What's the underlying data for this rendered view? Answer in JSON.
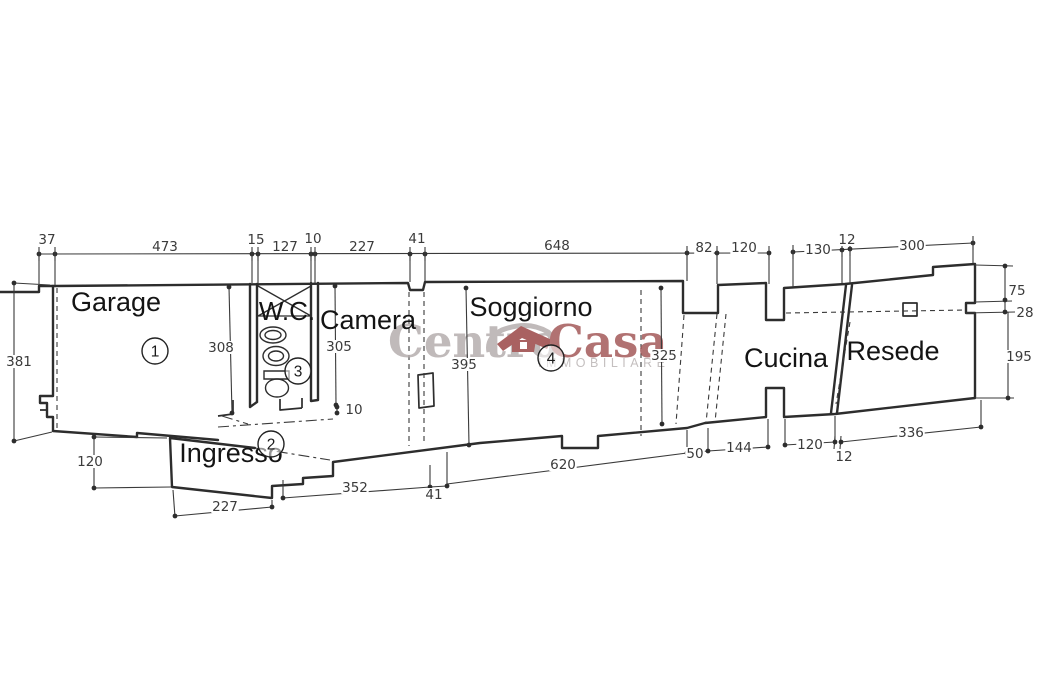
{
  "plan": {
    "type_label": "floor-plan",
    "rooms": [
      {
        "label": "Garage",
        "x": 116,
        "y": 311,
        "fs": 27,
        "num": "1",
        "nx": 155,
        "ny": 351
      },
      {
        "label": "Ingresso",
        "x": 231,
        "y": 462,
        "fs": 27,
        "num": "2",
        "nx": 271,
        "ny": 444
      },
      {
        "label": "W.C.",
        "x": 287,
        "y": 320,
        "fs": 26,
        "num": "3",
        "nx": 298,
        "ny": 371
      },
      {
        "label": "Camera",
        "x": 368,
        "y": 329,
        "fs": 27
      },
      {
        "label": "Soggiorno",
        "x": 531,
        "y": 316,
        "fs": 27,
        "num": "4",
        "nx": 551,
        "ny": 358
      },
      {
        "label": "Cucina",
        "x": 786,
        "y": 367,
        "fs": 27
      },
      {
        "label": "Resede",
        "x": 893,
        "y": 360,
        "fs": 27
      }
    ],
    "dimensions": [
      {
        "t": "37",
        "x": 47,
        "y": 244
      },
      {
        "t": "473",
        "x": 165,
        "y": 251
      },
      {
        "t": "15",
        "x": 256,
        "y": 244
      },
      {
        "t": "127",
        "x": 285,
        "y": 251
      },
      {
        "t": "10",
        "x": 313,
        "y": 243
      },
      {
        "t": "227",
        "x": 362,
        "y": 251
      },
      {
        "t": "41",
        "x": 417,
        "y": 243
      },
      {
        "t": "648",
        "x": 557,
        "y": 250
      },
      {
        "t": "82",
        "x": 704,
        "y": 252
      },
      {
        "t": "120",
        "x": 744,
        "y": 252
      },
      {
        "t": "130",
        "x": 818,
        "y": 254
      },
      {
        "t": "12",
        "x": 847,
        "y": 244
      },
      {
        "t": "300",
        "x": 912,
        "y": 250
      },
      {
        "t": "75",
        "x": 1017,
        "y": 295
      },
      {
        "t": "28",
        "x": 1025,
        "y": 317
      },
      {
        "t": "195",
        "x": 1019,
        "y": 361
      },
      {
        "t": "381",
        "x": 19,
        "y": 366
      },
      {
        "t": "308",
        "x": 221,
        "y": 352
      },
      {
        "t": "305",
        "x": 339,
        "y": 351
      },
      {
        "t": "10",
        "x": 354,
        "y": 414
      },
      {
        "t": "395",
        "x": 464,
        "y": 369
      },
      {
        "t": "325",
        "x": 664,
        "y": 360
      },
      {
        "t": "120",
        "x": 90,
        "y": 466
      },
      {
        "t": "227",
        "x": 225,
        "y": 511
      },
      {
        "t": "352",
        "x": 355,
        "y": 492
      },
      {
        "t": "41",
        "x": 434,
        "y": 499
      },
      {
        "t": "620",
        "x": 563,
        "y": 469
      },
      {
        "t": "50",
        "x": 695,
        "y": 458
      },
      {
        "t": "144",
        "x": 739,
        "y": 452
      },
      {
        "t": "120",
        "x": 810,
        "y": 449
      },
      {
        "t": "12",
        "x": 844,
        "y": 461
      },
      {
        "t": "336",
        "x": 911,
        "y": 437
      }
    ]
  },
  "watermark": {
    "part1": "Centro",
    "part2": "Casa",
    "subtitle": "IMMOBILIARE",
    "color_centro": "#b3abab",
    "color_casa": "#a15454",
    "color_house": "#973f3f",
    "color_sub": "#b8b2b2"
  }
}
